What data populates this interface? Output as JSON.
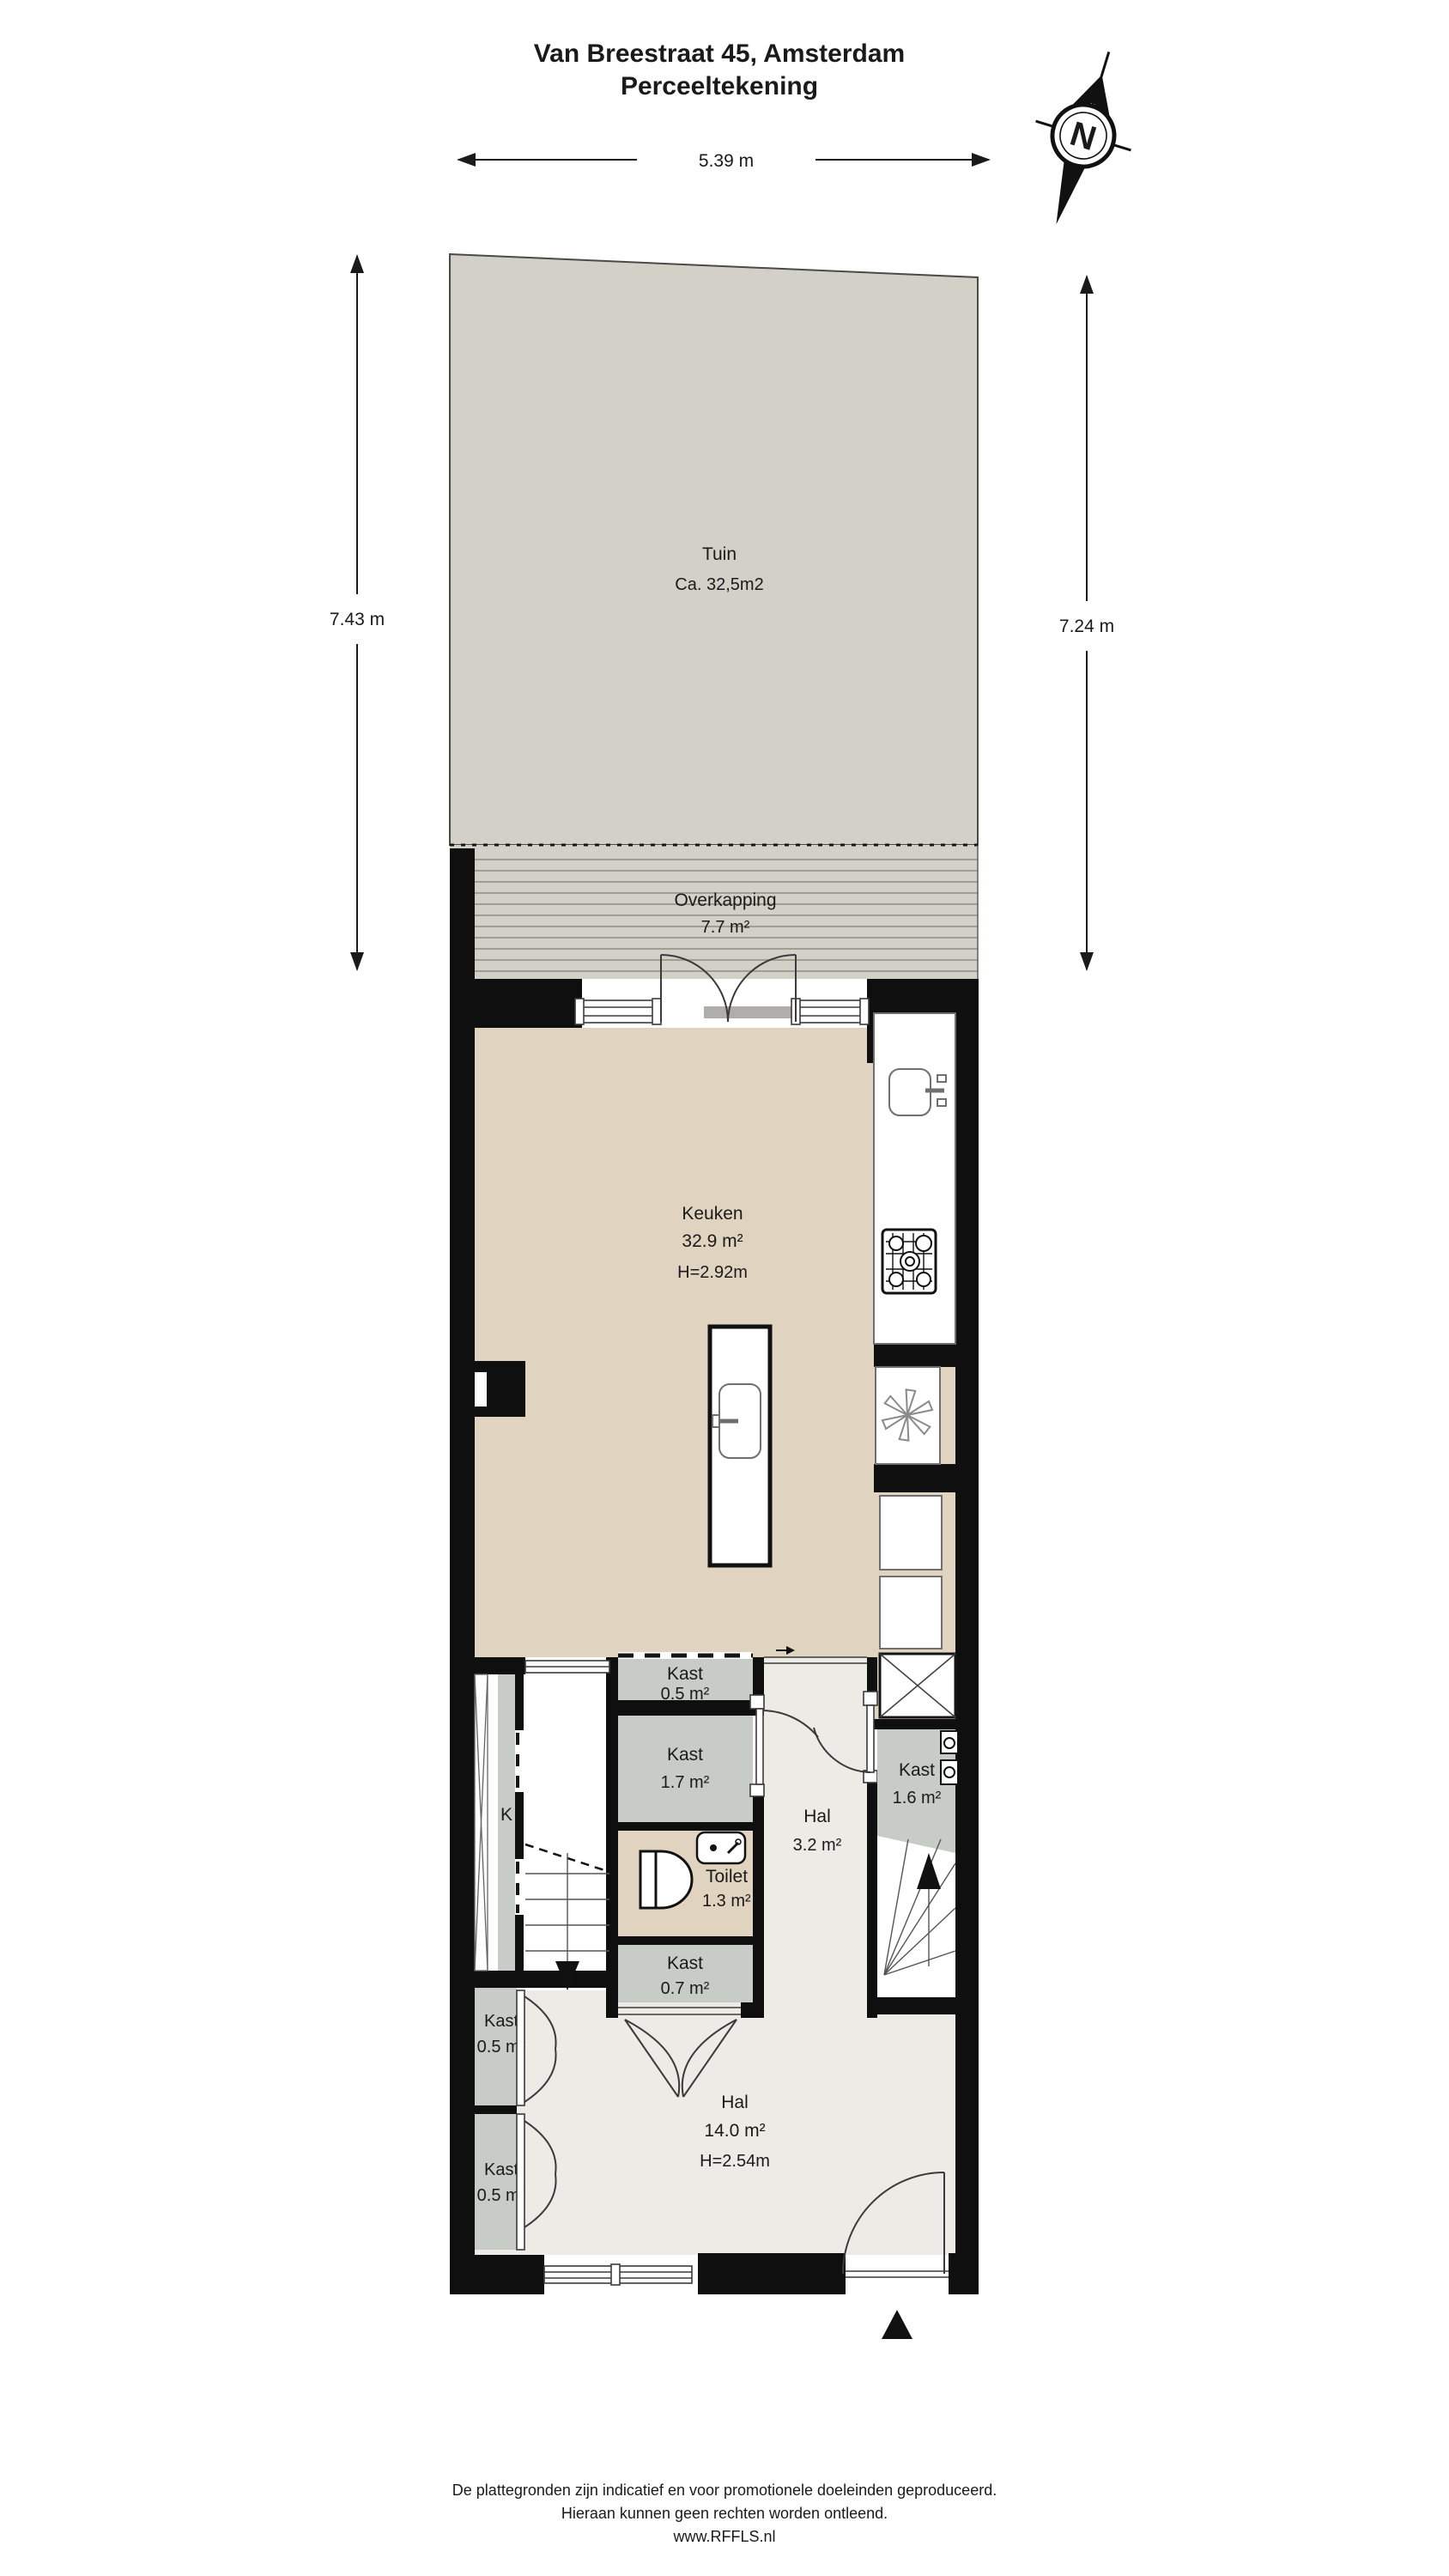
{
  "title": {
    "line1": "Van Breestraat 45, Amsterdam",
    "line2": "Perceeltekening"
  },
  "compass": {
    "north_label": "N"
  },
  "dimensions": {
    "width_top": "5.39 m",
    "height_left": "7.43 m",
    "height_right": "7.24 m"
  },
  "rooms": {
    "tuin": {
      "name": "Tuin",
      "area": "Ca. 32,5m2"
    },
    "overkapping": {
      "name": "Overkapping",
      "area": "7.7 m²"
    },
    "keuken": {
      "name": "Keuken",
      "area": "32.9 m²",
      "ceiling": "H=2.92m"
    },
    "kast_boven": {
      "name": "Kast",
      "area": "0.5 m²"
    },
    "kast_midden": {
      "name": "Kast",
      "area": "1.7 m²"
    },
    "toilet": {
      "name": "Toilet",
      "area": "1.3 m²"
    },
    "kast_onder": {
      "name": "Kast",
      "area": "0.7 m²"
    },
    "hal_klein": {
      "name": "Hal",
      "area": "3.2 m²"
    },
    "kast_rechts": {
      "name": "Kast",
      "area": "1.6 m²"
    },
    "kast_k": {
      "name": "K"
    },
    "kast_links_1": {
      "name": "Kast",
      "area": "0.5 m²"
    },
    "kast_links_2": {
      "name": "Kast",
      "area": "0.5 m²"
    },
    "hal_groot": {
      "name": "Hal",
      "area": "14.0 m²",
      "ceiling": "H=2.54m"
    }
  },
  "footer": {
    "line1": "De plattegronden zijn indicatief en voor promotionele doeleinden geproduceerd.",
    "line2": "Hieraan kunnen geen rechten worden ontleend.",
    "line3": "www.RFFLS.nl"
  },
  "colors": {
    "wall": "#0f0f0f",
    "tuin": "#d3d0c8",
    "stripe": "#a09d93",
    "beige": "#e0d4c0",
    "light": "#ecebe6",
    "kast": "#c8ccc6",
    "sill": "#b0aeaa"
  }
}
